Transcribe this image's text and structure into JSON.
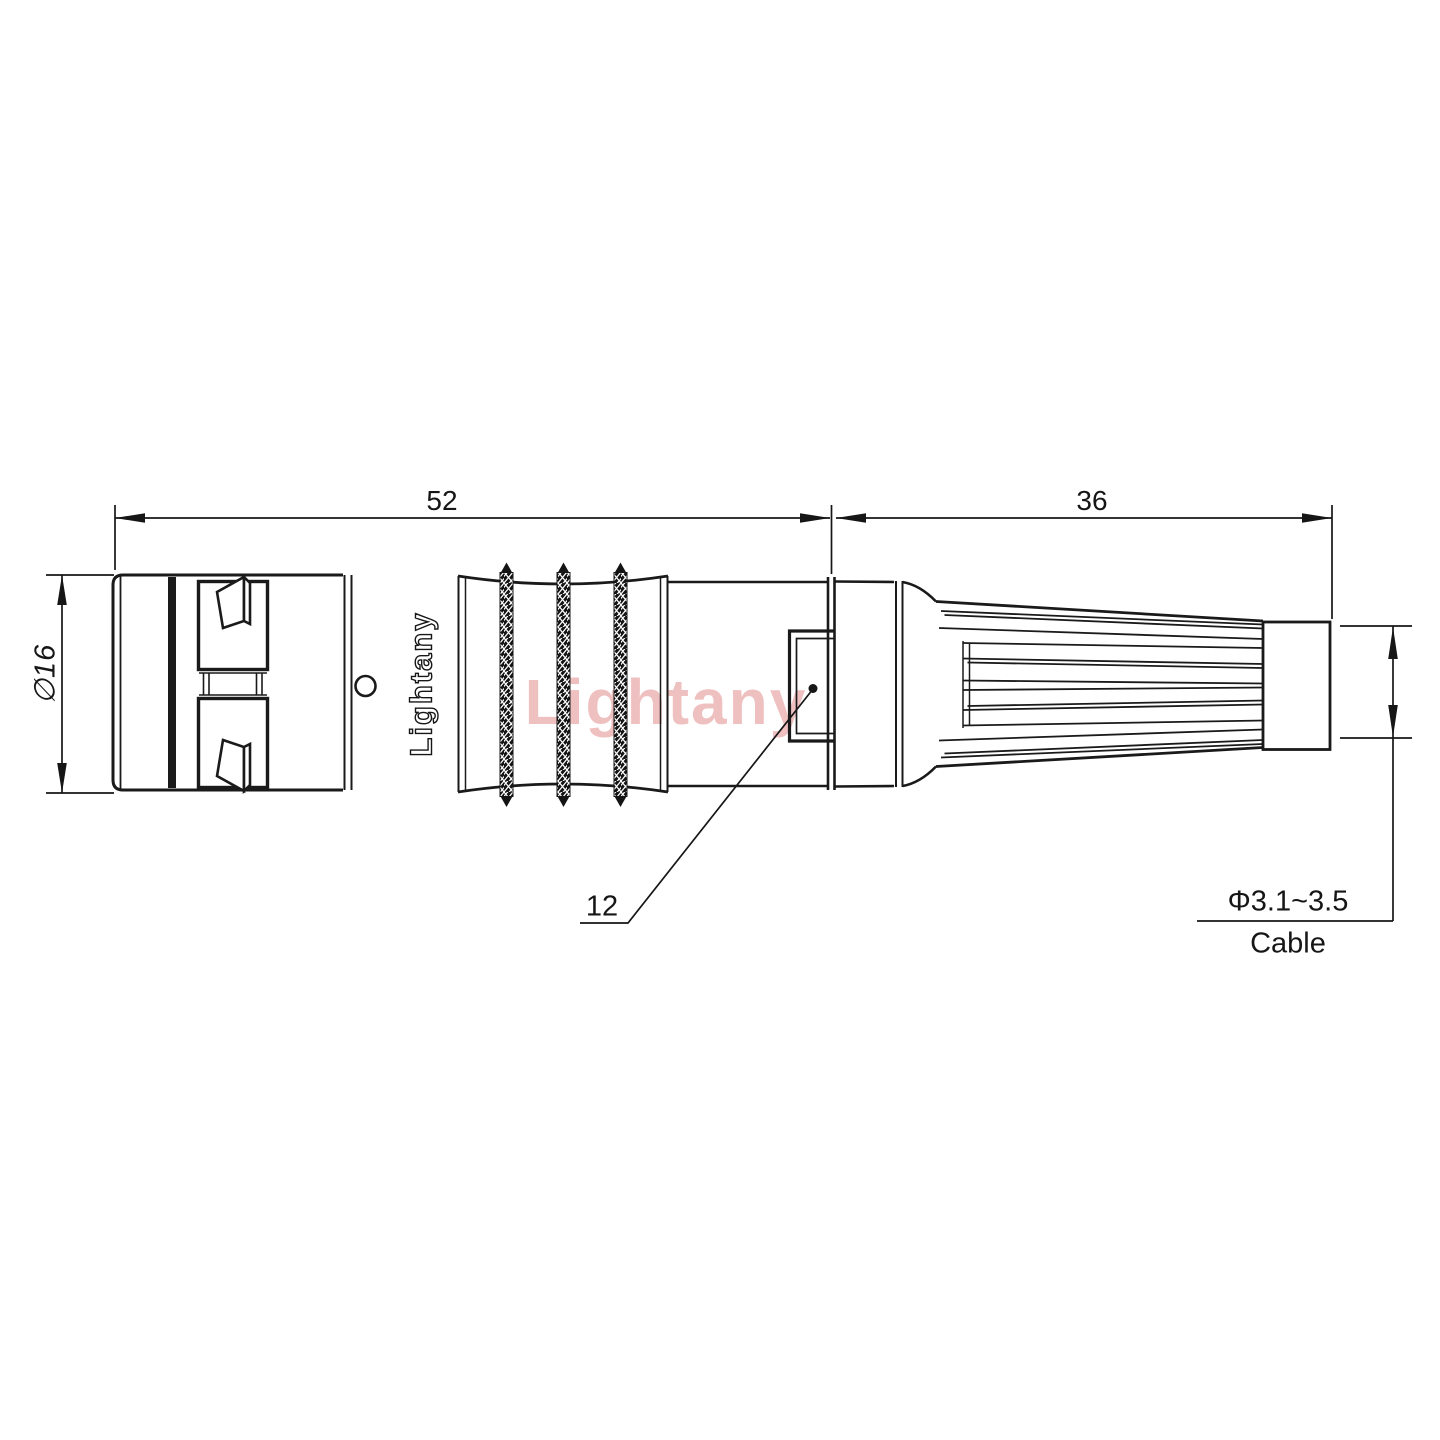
{
  "drawing": {
    "type": "technical-connector-drawing",
    "brand": {
      "body_text": "Lightany",
      "watermark": "Lightany"
    },
    "dims": {
      "front_length": "52",
      "boot_length": "36",
      "outer_diameter": "∅16",
      "window": "12",
      "cable_range": "Φ3.1~3.5",
      "cable_label": "Cable"
    },
    "colors": {
      "line": "#1a1a1a",
      "dimension_line": "#161616",
      "watermark_pink": "#edb6b6",
      "background": "#ffffff"
    }
  }
}
